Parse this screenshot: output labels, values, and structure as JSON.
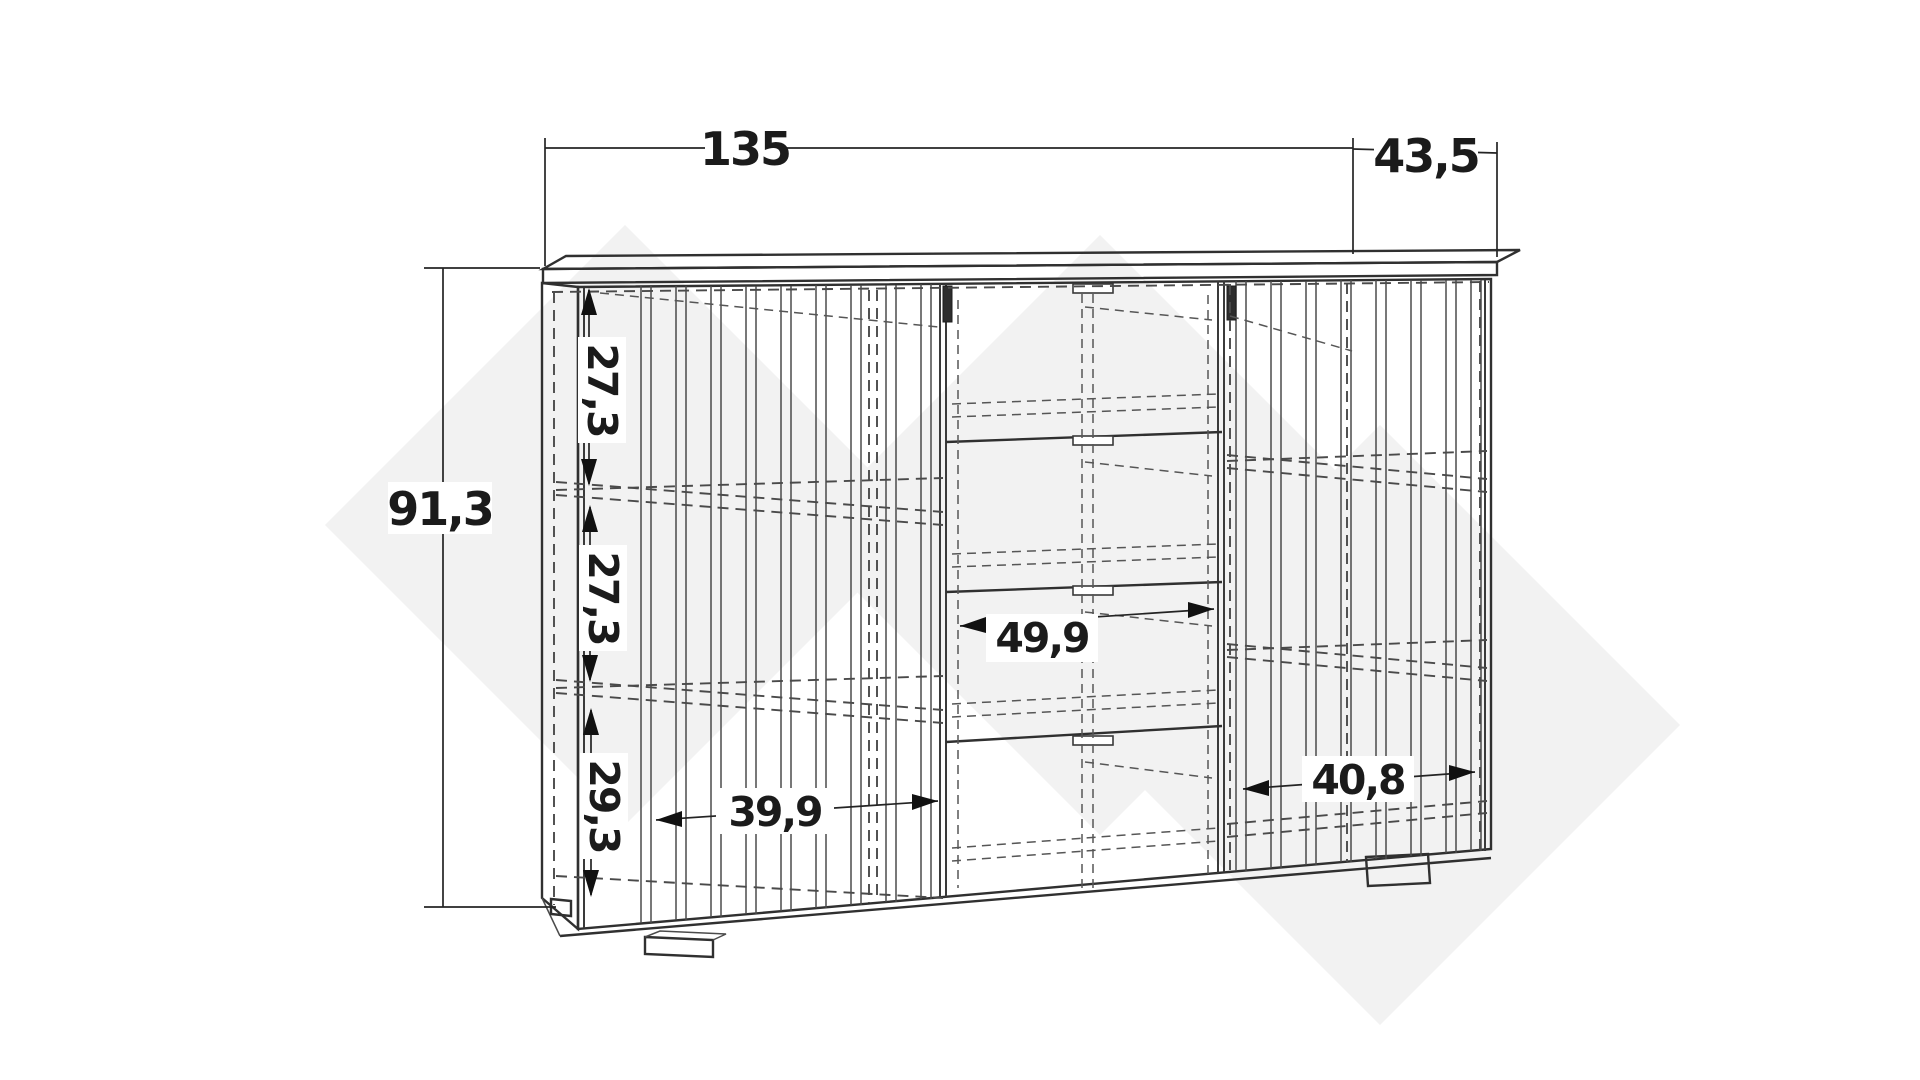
{
  "diagram": {
    "kind": "furniture-technical-drawing",
    "dims": {
      "total_width": "135",
      "depth": "43,5",
      "total_height": "91,3",
      "upper_section_height": "27,3",
      "middle_section_height": "27,3",
      "lower_section_height": "29,3",
      "left_compartment_width": "39,9",
      "center_compartment_width": "49,9",
      "right_compartment_width": "40,8"
    },
    "colors": {
      "background": "#ffffff",
      "line": "#303030",
      "hidden_line": "#4a4a4a",
      "label": "#1b1b1b",
      "watermark": "#f2f2f2"
    }
  }
}
